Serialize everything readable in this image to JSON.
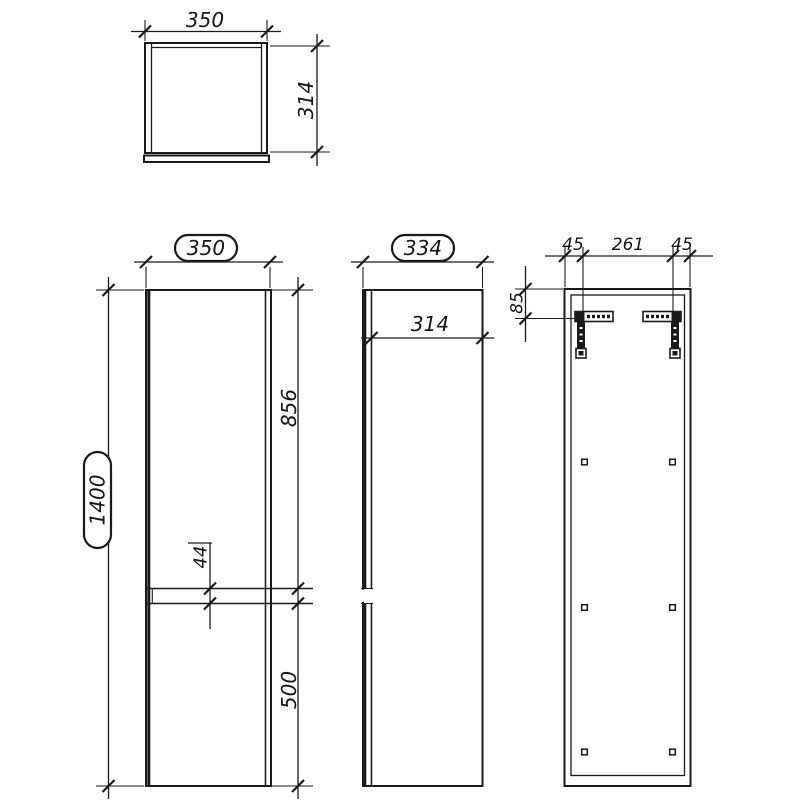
{
  "background": "#ffffff",
  "line_color": "#1a1a1a",
  "dimensions": {
    "top_view": {
      "width": "350",
      "depth": "314"
    },
    "front_view": {
      "width": "350",
      "height": "1400",
      "upper_door": "856",
      "gap": "44",
      "lower_door": "500"
    },
    "side_view": {
      "total_depth": "334",
      "carcass_depth": "314"
    },
    "back_view": {
      "left_offset": "45",
      "bracket_spacing": "261",
      "right_offset": "45",
      "top_offset": "85"
    }
  }
}
